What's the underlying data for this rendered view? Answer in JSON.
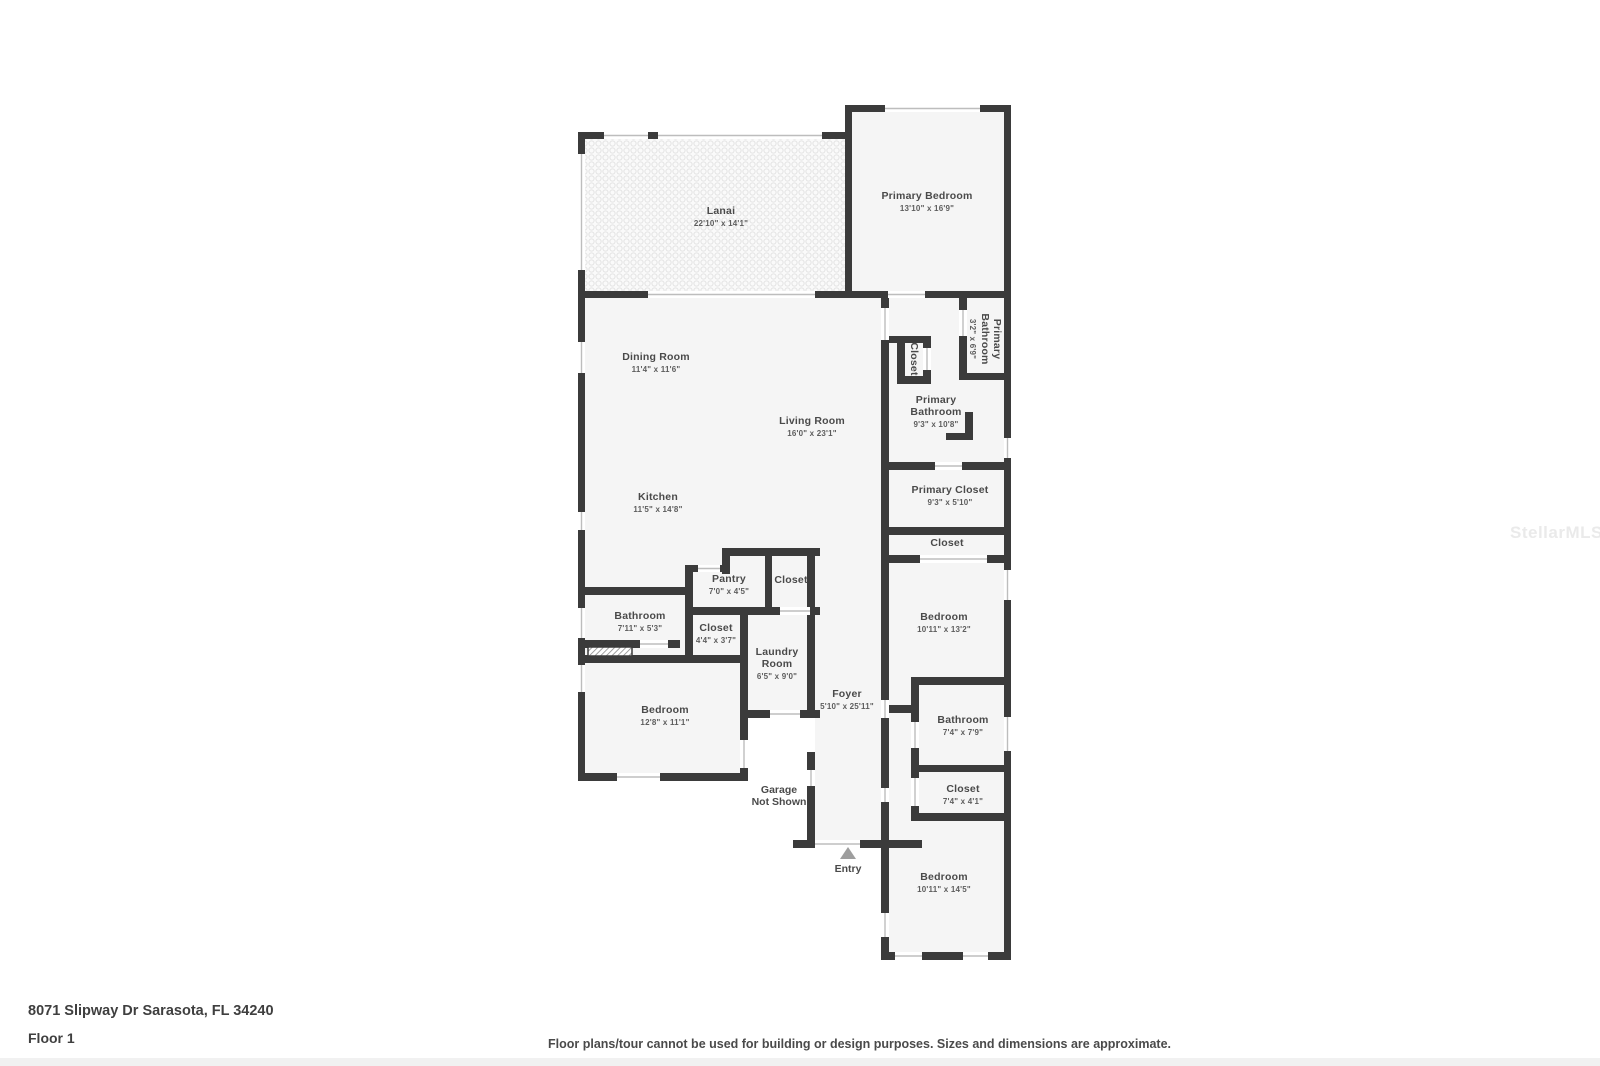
{
  "watermark": "StellarMLS",
  "footer": {
    "address": "8071 Slipway Dr Sarasota, FL 34240",
    "floor_label": "Floor 1",
    "disclaimer": "Floor plans/tour cannot be used for building or design purposes. Sizes and dimensions are approximate."
  },
  "plan": {
    "entry_label": "Entry",
    "garage_note_line1": "Garage",
    "garage_note_line2": "Not Shown",
    "rooms": [
      {
        "name": "Lanai",
        "dims": "22'10\" x 14'1\""
      },
      {
        "name": "Primary Bedroom",
        "dims": "13'10\" x 16'9\""
      },
      {
        "name": "Dining Room",
        "dims": "11'4\" x 11'6\""
      },
      {
        "name": "Living Room",
        "dims": "16'0\" x 23'1\""
      },
      {
        "name": "Kitchen",
        "dims": "11'5\" x 14'8\""
      },
      {
        "name": "Primary Bathroom",
        "dims": "3'2\" x 6'9\""
      },
      {
        "name": "Closet",
        "dims": ""
      },
      {
        "name": "Primary Bathroom",
        "dims": "9'3\" x 10'8\""
      },
      {
        "name": "Primary Closet",
        "dims": "9'3\" x 5'10\""
      },
      {
        "name": "Closet",
        "dims": ""
      },
      {
        "name": "Pantry",
        "dims": "7'0\" x 4'5\""
      },
      {
        "name": "Closet",
        "dims": ""
      },
      {
        "name": "Bathroom",
        "dims": "7'11\" x 5'3\""
      },
      {
        "name": "Closet",
        "dims": "4'4\" x 3'7\""
      },
      {
        "name": "Laundry Room",
        "dims": "6'5\" x 9'0\""
      },
      {
        "name": "Bedroom",
        "dims": "12'8\" x 11'1\""
      },
      {
        "name": "Foyer",
        "dims": "5'10\" x 25'11\""
      },
      {
        "name": "Bedroom",
        "dims": "10'11\" x 13'2\""
      },
      {
        "name": "Bathroom",
        "dims": "7'4\" x 7'9\""
      },
      {
        "name": "Closet",
        "dims": "7'4\" x 4'1\""
      },
      {
        "name": "Bedroom",
        "dims": "10'11\" x 14'5\""
      }
    ]
  }
}
